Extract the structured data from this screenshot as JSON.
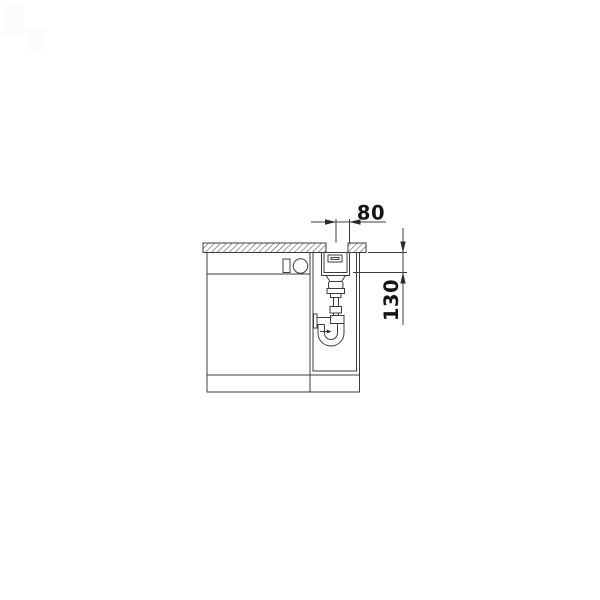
{
  "dimensions": {
    "drain_offset": {
      "label": "80"
    },
    "bowl_depth": {
      "label": "130"
    }
  },
  "colors": {
    "line": "#3c3c3c",
    "text": "#141414",
    "background": "#ffffff"
  }
}
